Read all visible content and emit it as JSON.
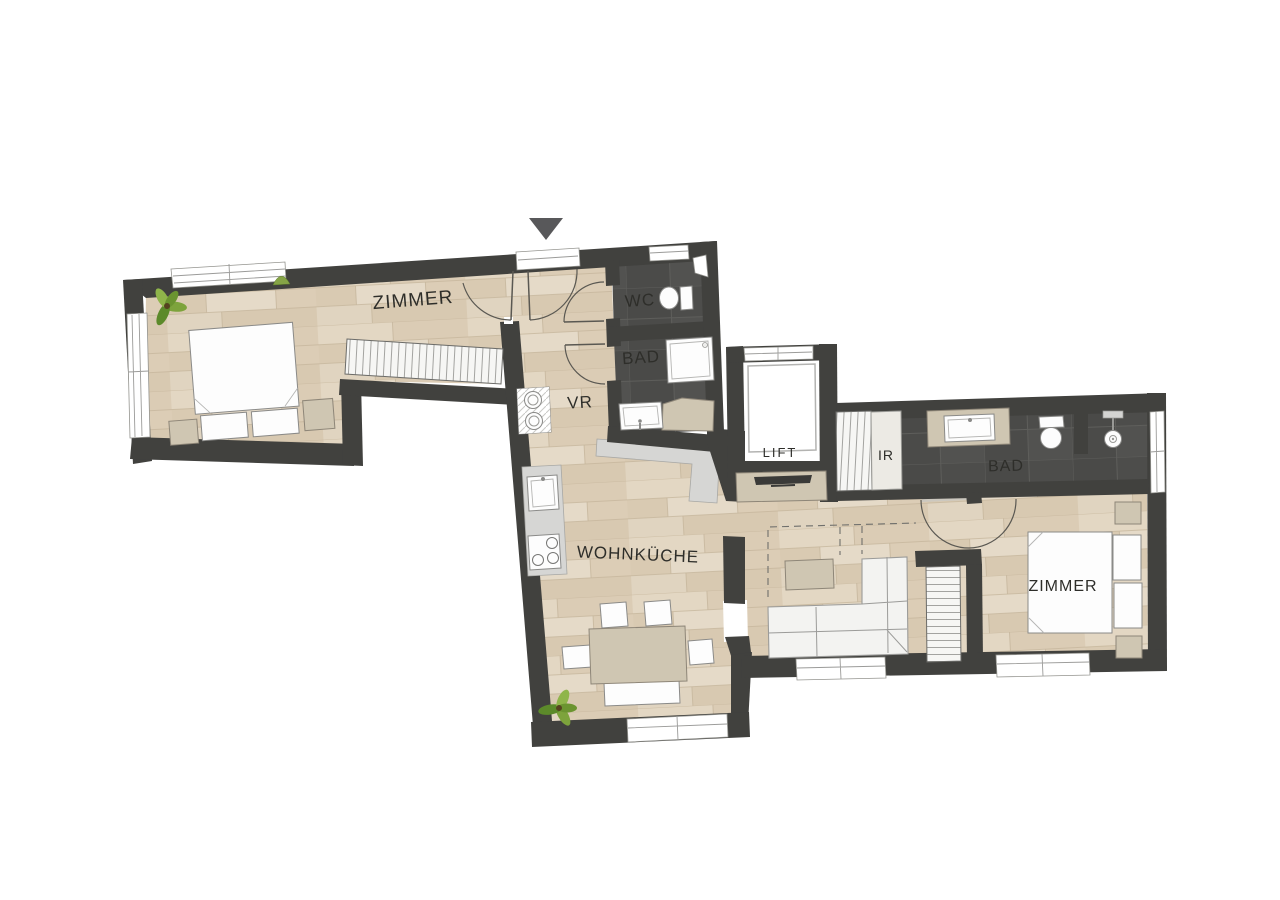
{
  "rooms": {
    "zimmer_left": {
      "label": "ZIMMER"
    },
    "wc": {
      "label": "WC"
    },
    "bad_left": {
      "label": "BAD"
    },
    "vr": {
      "label": "VR"
    },
    "wohnkueche": {
      "label": "WOHNKÜCHE"
    },
    "lift": {
      "label": "LIFT"
    },
    "ir": {
      "label": "IR"
    },
    "bad_right": {
      "label": "BAD"
    },
    "zimmer_right": {
      "label": "ZIMMER"
    }
  },
  "icons": {
    "entrance_marker": "down-triangle",
    "plant": "leafy-plant",
    "washer_dryer": "stacked-drums",
    "cooktop": "four-burners",
    "shower_head": "shower",
    "tv": "flat-screen"
  },
  "palette": {
    "wall": "#41413e",
    "wood_floor": "#decfb9",
    "tile_dark": "#4e4e4c",
    "furniture_beige": "#cfc6b2",
    "counter_gray": "#d6d6d4",
    "fixture_white": "#fdfdfd",
    "plant_green": "#76a032",
    "label_text": "#2e2e2a",
    "entrance_marker_gray": "#58585a",
    "background": "#ffffff"
  }
}
